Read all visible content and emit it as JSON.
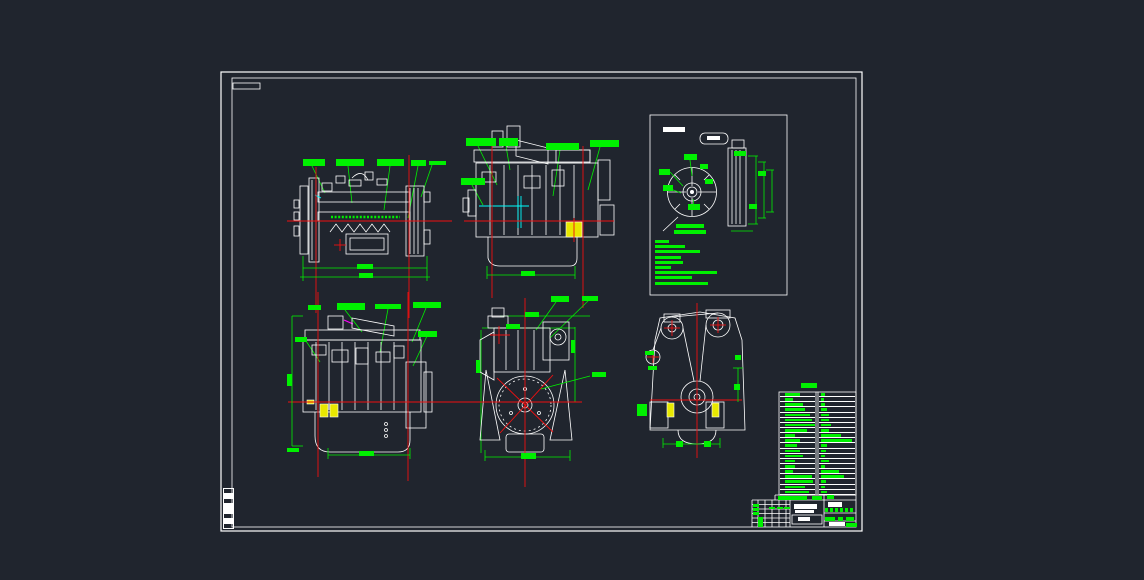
{
  "colors": {
    "background": "#20252e",
    "drawing_lines": "#ffffff",
    "annotation_green": "#00f000",
    "centerline_red": "#f01010",
    "detail_cyan": "#00ffff",
    "highlight_yellow": "#e8e800",
    "accent_magenta": "#ff00ff"
  },
  "green_labels": [
    [
      303,
      159,
      22,
      7
    ],
    [
      336,
      159,
      28,
      7
    ],
    [
      377,
      159,
      27,
      7
    ],
    [
      411,
      160,
      15,
      6
    ],
    [
      429,
      161,
      13,
      4
    ],
    [
      357,
      264,
      16,
      5
    ],
    [
      359,
      273,
      14,
      5
    ],
    [
      466,
      138,
      30,
      8
    ],
    [
      499,
      138,
      19,
      8
    ],
    [
      546,
      143,
      33,
      7
    ],
    [
      590,
      140,
      29,
      7
    ],
    [
      461,
      178,
      24,
      7
    ],
    [
      437,
      161,
      9,
      4
    ],
    [
      521,
      271,
      14,
      5
    ],
    [
      676,
      224,
      28,
      4
    ],
    [
      674,
      230,
      32,
      4
    ],
    [
      659,
      169,
      11,
      6
    ],
    [
      684,
      154,
      13,
      6
    ],
    [
      700,
      164,
      8,
      5
    ],
    [
      663,
      185,
      10,
      6
    ],
    [
      688,
      204,
      12,
      6
    ],
    [
      705,
      179,
      8,
      5
    ],
    [
      734,
      151,
      12,
      5
    ],
    [
      749,
      204,
      8,
      5
    ],
    [
      758,
      171,
      8,
      5
    ],
    [
      308,
      305,
      13,
      5
    ],
    [
      337,
      303,
      28,
      7
    ],
    [
      375,
      304,
      26,
      5
    ],
    [
      413,
      302,
      28,
      6
    ],
    [
      418,
      331,
      19,
      6
    ],
    [
      295,
      337,
      12,
      5
    ],
    [
      359,
      451,
      15,
      5
    ],
    [
      287,
      448,
      12,
      4
    ],
    [
      287,
      374,
      5,
      12
    ],
    [
      551,
      296,
      18,
      6
    ],
    [
      582,
      296,
      16,
      5
    ],
    [
      525,
      312,
      14,
      5
    ],
    [
      506,
      324,
      14,
      5
    ],
    [
      592,
      372,
      14,
      5
    ],
    [
      476,
      360,
      4,
      13
    ],
    [
      571,
      340,
      4,
      13
    ],
    [
      521,
      453,
      15,
      6
    ],
    [
      645,
      351,
      9,
      4
    ],
    [
      648,
      366,
      9,
      4
    ],
    [
      637,
      404,
      10,
      12
    ],
    [
      735,
      355,
      6,
      5
    ],
    [
      734,
      384,
      6,
      6
    ],
    [
      676,
      441,
      7,
      6
    ],
    [
      704,
      441,
      7,
      6
    ],
    [
      801,
      383,
      16,
      5
    ],
    [
      778,
      496,
      29,
      4
    ],
    [
      812,
      496,
      10,
      4
    ],
    [
      827,
      495,
      7,
      4
    ],
    [
      753,
      504,
      6,
      3
    ],
    [
      753,
      508,
      6,
      3
    ],
    [
      753,
      512,
      6,
      3
    ],
    [
      758,
      517,
      5,
      10
    ],
    [
      769,
      507,
      6,
      2
    ],
    [
      777,
      507,
      6,
      2
    ],
    [
      784,
      507,
      6,
      2
    ],
    [
      825,
      517,
      10,
      4
    ],
    [
      838,
      517,
      5,
      4
    ],
    [
      846,
      517,
      8,
      4
    ],
    [
      846,
      523,
      11,
      4
    ],
    [
      825,
      508,
      3,
      4
    ],
    [
      830,
      508,
      3,
      4
    ],
    [
      835,
      508,
      3,
      4
    ],
    [
      840,
      508,
      3,
      4
    ],
    [
      845,
      508,
      3,
      4
    ],
    [
      850,
      508,
      3,
      4
    ]
  ],
  "white_labels": [
    [
      663,
      127,
      22,
      5
    ],
    [
      707,
      136,
      13,
      4
    ],
    [
      794,
      504,
      23,
      5
    ],
    [
      795,
      510,
      19,
      3
    ],
    [
      798,
      517,
      12,
      4
    ],
    [
      828,
      502,
      14,
      5
    ],
    [
      829,
      522,
      16,
      4
    ]
  ],
  "inset_notes": [
    14,
    30,
    45,
    26,
    28,
    16,
    62,
    37,
    53
  ],
  "spec_table": {
    "rows": [
      [
        15,
        4
      ],
      [
        8,
        3
      ],
      [
        18,
        4
      ],
      [
        20,
        6
      ],
      [
        25,
        8
      ],
      [
        27,
        8
      ],
      [
        30,
        10
      ],
      [
        22,
        8
      ],
      [
        10,
        20
      ],
      [
        15,
        31
      ],
      [
        12,
        6
      ],
      [
        15,
        5
      ],
      [
        18,
        4
      ],
      [
        10,
        8
      ],
      [
        10,
        4
      ],
      [
        8,
        18
      ],
      [
        27,
        23
      ],
      [
        28,
        5
      ],
      [
        20,
        4
      ],
      [
        24,
        6
      ]
    ]
  },
  "margin_marks": [
    [
      488,
      0
    ],
    [
      493,
      1
    ],
    [
      498,
      0
    ],
    [
      503,
      1
    ],
    [
      508,
      1
    ],
    [
      513,
      0
    ],
    [
      518,
      1
    ],
    [
      523,
      0
    ]
  ]
}
